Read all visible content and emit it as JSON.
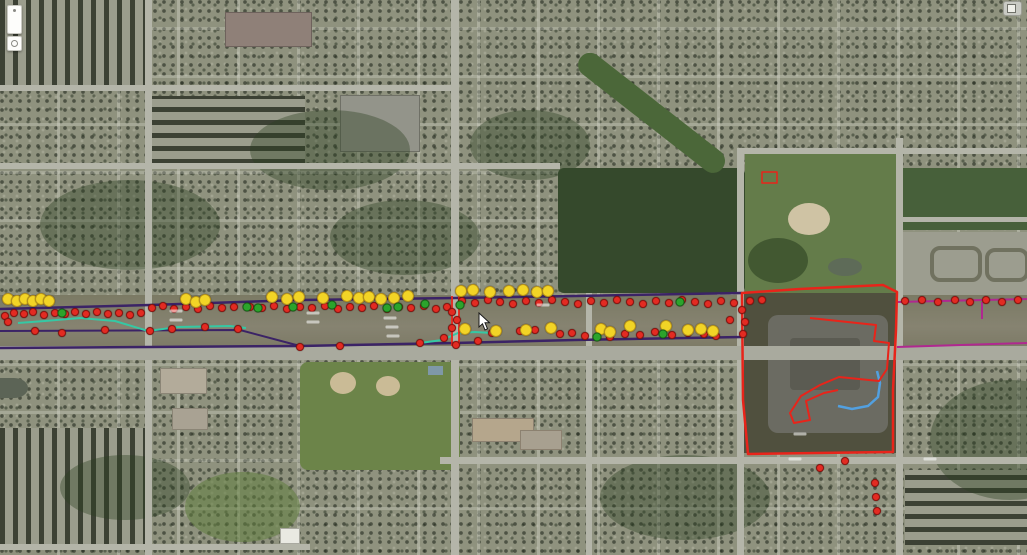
{
  "map": {
    "palette": {
      "marker_red": "#e32b22",
      "marker_yellow": "#f2d426",
      "marker_green": "#2ca32c",
      "row_boundary_purple": "#3b2366",
      "parcel_magenta": "#b02890",
      "survey_red": "#e8241a",
      "gps_teal": "#35c8a4",
      "water_blue": "#52a0e0"
    },
    "corridor_lines": [
      {
        "name": "row-boundary-top",
        "color": "#3b2366",
        "width": 2.5,
        "points": [
          [
            0,
            309
          ],
          [
            150,
            305
          ],
          [
            300,
            300
          ],
          [
            455,
            298
          ],
          [
            575,
            296
          ],
          [
            742,
            293
          ]
        ]
      },
      {
        "name": "row-boundary-bottom",
        "color": "#3b2366",
        "width": 2.5,
        "points": [
          [
            0,
            348
          ],
          [
            150,
            347
          ],
          [
            300,
            346
          ],
          [
            455,
            343
          ],
          [
            575,
            340
          ],
          [
            742,
            337
          ]
        ]
      },
      {
        "name": "row-boundary-mid",
        "color": "#3b2366",
        "width": 2,
        "points": [
          [
            0,
            331
          ],
          [
            240,
            330
          ],
          [
            300,
            346
          ]
        ]
      },
      {
        "name": "parcel-line-right-top",
        "color": "#b02890",
        "width": 2,
        "points": [
          [
            897,
            302
          ],
          [
            1027,
            299
          ]
        ]
      },
      {
        "name": "parcel-line-right-bottom",
        "color": "#b02890",
        "width": 2,
        "points": [
          [
            897,
            347
          ],
          [
            1027,
            343
          ]
        ]
      },
      {
        "name": "parcel-line-right-vertical",
        "color": "#b02890",
        "width": 2,
        "points": [
          [
            982,
            302
          ],
          [
            982,
            319
          ]
        ]
      }
    ],
    "red_lines": [
      {
        "name": "red-cross-street-line-west",
        "points": [
          [
            452,
            296
          ],
          [
            452,
            346
          ]
        ]
      },
      {
        "name": "red-cross-street-line-east",
        "points": [
          [
            459,
            296
          ],
          [
            459,
            346
          ]
        ]
      }
    ],
    "teal_lines": [
      {
        "name": "gps-track-west",
        "color": "#35c8a4",
        "width": 2,
        "points": [
          [
            18,
            323
          ],
          [
            45,
            321
          ],
          [
            80,
            318
          ],
          [
            115,
            321
          ],
          [
            148,
            331
          ],
          [
            178,
            327
          ],
          [
            230,
            326
          ],
          [
            246,
            328
          ]
        ]
      },
      {
        "name": "gps-track-center",
        "color": "#35c8a4",
        "width": 2,
        "points": [
          [
            420,
            343
          ],
          [
            442,
            340
          ],
          [
            458,
            333
          ],
          [
            475,
            332
          ],
          [
            492,
            333
          ]
        ]
      }
    ],
    "blue_line": {
      "name": "blue-feature-line",
      "color": "#52a0e0",
      "width": 2.5,
      "points": [
        [
          838,
          406
        ],
        [
          852,
          409
        ],
        [
          868,
          406
        ],
        [
          878,
          397
        ],
        [
          880,
          383
        ],
        [
          877,
          371
        ]
      ]
    },
    "polygons": [
      {
        "name": "site-parcel-outline",
        "stroke": "#e8241a",
        "width": 2.5,
        "closed": true,
        "points": [
          [
            742,
            293
          ],
          [
            800,
            289
          ],
          [
            883,
            285
          ],
          [
            897,
            292
          ],
          [
            896,
            330
          ],
          [
            893,
            390
          ],
          [
            893,
            452
          ],
          [
            748,
            454
          ],
          [
            743,
            400
          ]
        ]
      },
      {
        "name": "building-survey-outline",
        "stroke": "#e8241a",
        "width": 2,
        "closed": false,
        "points": [
          [
            810,
            318
          ],
          [
            876,
            325
          ],
          [
            874,
            341
          ],
          [
            889,
            343
          ],
          [
            887,
            369
          ],
          [
            879,
            381
          ],
          [
            839,
            377
          ],
          [
            820,
            385
          ],
          [
            801,
            396
          ],
          [
            790,
            413
          ],
          [
            794,
            423
          ],
          [
            810,
            420
          ],
          [
            806,
            401
          ],
          [
            824,
            393
          ],
          [
            838,
            390
          ]
        ]
      },
      {
        "name": "park-building-outline",
        "stroke": "#e8241a",
        "width": 1.5,
        "closed": true,
        "points": [
          [
            762,
            172
          ],
          [
            777,
            172
          ],
          [
            777,
            183
          ],
          [
            762,
            183
          ]
        ]
      }
    ],
    "markers": {
      "red": [
        [
          5,
          316
        ],
        [
          14,
          313
        ],
        [
          24,
          314
        ],
        [
          33,
          312
        ],
        [
          44,
          315
        ],
        [
          55,
          313
        ],
        [
          65,
          314
        ],
        [
          75,
          312
        ],
        [
          86,
          314
        ],
        [
          97,
          312
        ],
        [
          108,
          314
        ],
        [
          119,
          313
        ],
        [
          130,
          315
        ],
        [
          141,
          313
        ],
        [
          152,
          308
        ],
        [
          163,
          306
        ],
        [
          174,
          309
        ],
        [
          186,
          307
        ],
        [
          198,
          309
        ],
        [
          210,
          306
        ],
        [
          222,
          308
        ],
        [
          234,
          307
        ],
        [
          250,
          307
        ],
        [
          262,
          308
        ],
        [
          274,
          306
        ],
        [
          287,
          309
        ],
        [
          300,
          307
        ],
        [
          312,
          308
        ],
        [
          325,
          306
        ],
        [
          338,
          309
        ],
        [
          350,
          307
        ],
        [
          362,
          308
        ],
        [
          374,
          306
        ],
        [
          387,
          309
        ],
        [
          399,
          307
        ],
        [
          411,
          308
        ],
        [
          424,
          306
        ],
        [
          436,
          309
        ],
        [
          447,
          307
        ],
        [
          462,
          301
        ],
        [
          475,
          303
        ],
        [
          488,
          300
        ],
        [
          500,
          302
        ],
        [
          513,
          304
        ],
        [
          526,
          301
        ],
        [
          539,
          303
        ],
        [
          552,
          300
        ],
        [
          565,
          302
        ],
        [
          578,
          304
        ],
        [
          591,
          301
        ],
        [
          604,
          303
        ],
        [
          617,
          300
        ],
        [
          630,
          302
        ],
        [
          643,
          304
        ],
        [
          656,
          301
        ],
        [
          669,
          303
        ],
        [
          682,
          300
        ],
        [
          695,
          302
        ],
        [
          708,
          304
        ],
        [
          721,
          301
        ],
        [
          734,
          303
        ],
        [
          8,
          322
        ],
        [
          35,
          331
        ],
        [
          62,
          333
        ],
        [
          105,
          330
        ],
        [
          150,
          331
        ],
        [
          172,
          329
        ],
        [
          205,
          327
        ],
        [
          238,
          329
        ],
        [
          300,
          347
        ],
        [
          340,
          346
        ],
        [
          420,
          343
        ],
        [
          444,
          338
        ],
        [
          452,
          312
        ],
        [
          457,
          320
        ],
        [
          452,
          328
        ],
        [
          456,
          345
        ],
        [
          478,
          341
        ],
        [
          492,
          333
        ],
        [
          520,
          331
        ],
        [
          535,
          330
        ],
        [
          560,
          334
        ],
        [
          572,
          333
        ],
        [
          585,
          336
        ],
        [
          610,
          337
        ],
        [
          625,
          334
        ],
        [
          640,
          335
        ],
        [
          655,
          332
        ],
        [
          672,
          335
        ],
        [
          688,
          333
        ],
        [
          704,
          334
        ],
        [
          716,
          336
        ],
        [
          730,
          320
        ],
        [
          742,
          310
        ],
        [
          745,
          322
        ],
        [
          743,
          334
        ],
        [
          750,
          301
        ],
        [
          762,
          300
        ],
        [
          905,
          301
        ],
        [
          922,
          300
        ],
        [
          938,
          302
        ],
        [
          955,
          300
        ],
        [
          970,
          302
        ],
        [
          986,
          300
        ],
        [
          1002,
          302
        ],
        [
          1018,
          300
        ],
        [
          845,
          461
        ],
        [
          820,
          468
        ],
        [
          875,
          483
        ],
        [
          876,
          497
        ],
        [
          877,
          511
        ]
      ],
      "yellow": [
        [
          8,
          299
        ],
        [
          17,
          301
        ],
        [
          25,
          299
        ],
        [
          33,
          301
        ],
        [
          41,
          299
        ],
        [
          49,
          301
        ],
        [
          186,
          299
        ],
        [
          196,
          302
        ],
        [
          205,
          300
        ],
        [
          272,
          297
        ],
        [
          287,
          299
        ],
        [
          299,
          297
        ],
        [
          323,
          298
        ],
        [
          347,
          296
        ],
        [
          359,
          298
        ],
        [
          369,
          297
        ],
        [
          381,
          299
        ],
        [
          394,
          298
        ],
        [
          408,
          296
        ],
        [
          461,
          291
        ],
        [
          473,
          290
        ],
        [
          490,
          292
        ],
        [
          509,
          291
        ],
        [
          523,
          290
        ],
        [
          537,
          292
        ],
        [
          548,
          291
        ],
        [
          465,
          329
        ],
        [
          496,
          331
        ],
        [
          526,
          330
        ],
        [
          551,
          328
        ],
        [
          601,
          329
        ],
        [
          610,
          332
        ],
        [
          630,
          326
        ],
        [
          666,
          326
        ],
        [
          688,
          330
        ],
        [
          701,
          329
        ],
        [
          713,
          331
        ]
      ],
      "green": [
        [
          62,
          313
        ],
        [
          247,
          307
        ],
        [
          258,
          308
        ],
        [
          293,
          307
        ],
        [
          332,
          305
        ],
        [
          387,
          308
        ],
        [
          398,
          307
        ],
        [
          425,
          304
        ],
        [
          460,
          305
        ],
        [
          597,
          337
        ],
        [
          663,
          334
        ],
        [
          680,
          302
        ]
      ]
    },
    "faint_labels": [
      [
        313,
        313
      ],
      [
        313,
        322
      ],
      [
        390,
        318
      ],
      [
        392,
        327
      ],
      [
        393,
        336
      ],
      [
        176,
        311
      ],
      [
        176,
        320
      ],
      [
        543,
        305
      ],
      [
        800,
        434
      ],
      [
        930,
        459
      ],
      [
        795,
        459
      ]
    ],
    "cursor": {
      "x": 478,
      "y": 312
    }
  },
  "icons": {
    "top_left_pin_control": "location-pin-control",
    "top_left_eye_control": "circle-target-control",
    "top_right_control": "map-panel-toggle"
  }
}
